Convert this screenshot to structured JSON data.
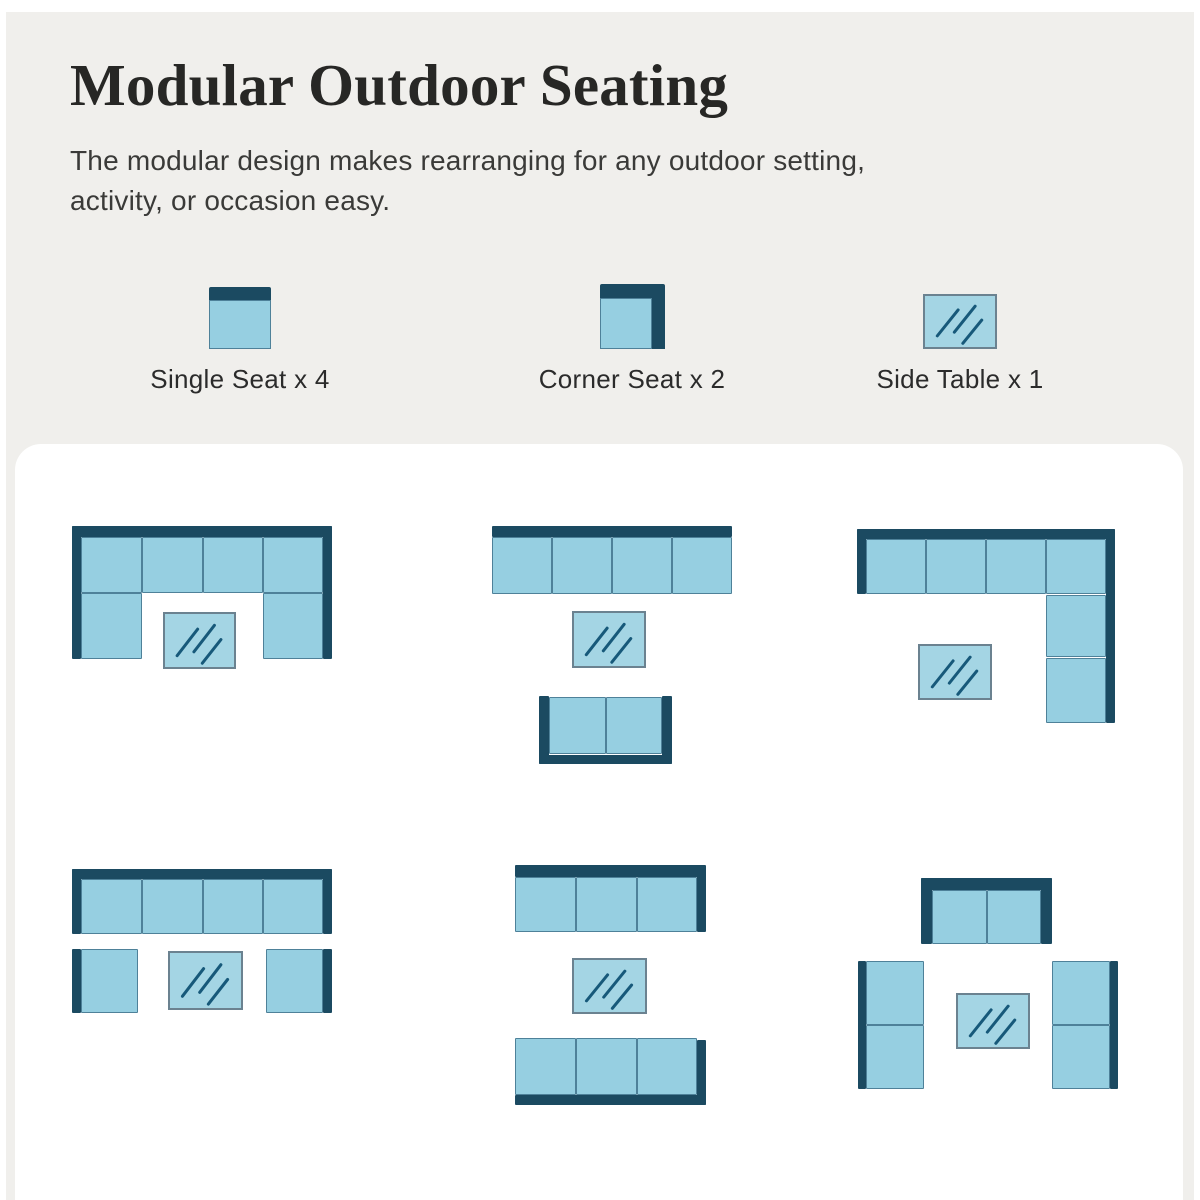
{
  "header": {
    "title": "Modular Outdoor Seating",
    "subtitle_line1": "The modular design makes rearranging for any outdoor setting,",
    "subtitle_line2": "activity, or occasion easy."
  },
  "colors": {
    "background": "#f0efec",
    "panel": "#ffffff",
    "navy": "#1b4a61",
    "cushion": "#96cfe1",
    "cushion_border": "#4e8199",
    "table_fill": "#a4d5e4",
    "table_border": "#6b8290",
    "table_line": "#17597a",
    "title_color": "#272725",
    "subtitle_color": "#3a3a38"
  },
  "legend": [
    {
      "id": "single-seat",
      "label": "Single Seat x 4"
    },
    {
      "id": "corner-seat",
      "label": "Corner Seat x 2"
    },
    {
      "id": "side-table",
      "label": "Side Table x 1"
    }
  ],
  "arrangements": [
    {
      "id": "u-shape-with-table",
      "x": 72,
      "y": 526,
      "w": 260,
      "h": 143,
      "pieces": [
        {
          "t": "bar",
          "x": 0,
          "y": 0,
          "w": 260,
          "h": 11
        },
        {
          "t": "bar",
          "x": 0,
          "y": 0,
          "w": 9,
          "h": 133
        },
        {
          "t": "bar",
          "x": 251,
          "y": 0,
          "w": 9,
          "h": 133
        },
        {
          "t": "cushion",
          "x": 9,
          "y": 11,
          "w": 61,
          "h": 56
        },
        {
          "t": "cushion",
          "x": 70,
          "y": 11,
          "w": 61,
          "h": 56
        },
        {
          "t": "cushion",
          "x": 131,
          "y": 11,
          "w": 60,
          "h": 56
        },
        {
          "t": "cushion",
          "x": 191,
          "y": 11,
          "w": 60,
          "h": 56
        },
        {
          "t": "cushion",
          "x": 9,
          "y": 67,
          "w": 61,
          "h": 66
        },
        {
          "t": "cushion",
          "x": 191,
          "y": 67,
          "w": 60,
          "h": 66
        },
        {
          "t": "table",
          "x": 91,
          "y": 86,
          "w": 73,
          "h": 57
        }
      ]
    },
    {
      "id": "sofa-table-loveseat",
      "x": 492,
      "y": 526,
      "w": 240,
      "h": 238,
      "pieces": [
        {
          "t": "bar",
          "x": 0,
          "y": 0,
          "w": 240,
          "h": 11
        },
        {
          "t": "cushion",
          "x": 0,
          "y": 11,
          "w": 60,
          "h": 57
        },
        {
          "t": "cushion",
          "x": 60,
          "y": 11,
          "w": 60,
          "h": 57
        },
        {
          "t": "cushion",
          "x": 120,
          "y": 11,
          "w": 60,
          "h": 57
        },
        {
          "t": "cushion",
          "x": 180,
          "y": 11,
          "w": 60,
          "h": 57
        },
        {
          "t": "table",
          "x": 80,
          "y": 85,
          "w": 74,
          "h": 57
        },
        {
          "t": "bar",
          "x": 47,
          "y": 170,
          "w": 10,
          "h": 68
        },
        {
          "t": "bar",
          "x": 170,
          "y": 170,
          "w": 10,
          "h": 68
        },
        {
          "t": "bar",
          "x": 47,
          "y": 229,
          "w": 133,
          "h": 9
        },
        {
          "t": "cushion",
          "x": 57,
          "y": 171,
          "w": 57,
          "h": 57
        },
        {
          "t": "cushion",
          "x": 114,
          "y": 171,
          "w": 56,
          "h": 57
        }
      ]
    },
    {
      "id": "l-shape-with-table",
      "x": 857,
      "y": 529,
      "w": 258,
      "h": 194,
      "pieces": [
        {
          "t": "bar",
          "x": 0,
          "y": 0,
          "w": 258,
          "h": 10
        },
        {
          "t": "bar",
          "x": 0,
          "y": 0,
          "w": 9,
          "h": 65
        },
        {
          "t": "bar",
          "x": 249,
          "y": 0,
          "w": 9,
          "h": 194
        },
        {
          "t": "cushion",
          "x": 9,
          "y": 10,
          "w": 60,
          "h": 55
        },
        {
          "t": "cushion",
          "x": 69,
          "y": 10,
          "w": 60,
          "h": 55
        },
        {
          "t": "cushion",
          "x": 129,
          "y": 10,
          "w": 60,
          "h": 55
        },
        {
          "t": "cushion",
          "x": 189,
          "y": 10,
          "w": 60,
          "h": 55
        },
        {
          "t": "cushion",
          "x": 189,
          "y": 66,
          "w": 60,
          "h": 62
        },
        {
          "t": "cushion",
          "x": 189,
          "y": 129,
          "w": 60,
          "h": 65
        },
        {
          "t": "table",
          "x": 61,
          "y": 115,
          "w": 74,
          "h": 56
        }
      ]
    },
    {
      "id": "sofa-with-two-chairs",
      "x": 72,
      "y": 869,
      "w": 260,
      "h": 145,
      "pieces": [
        {
          "t": "bar",
          "x": 0,
          "y": 0,
          "w": 260,
          "h": 10
        },
        {
          "t": "bar",
          "x": 0,
          "y": 0,
          "w": 9,
          "h": 65
        },
        {
          "t": "bar",
          "x": 251,
          "y": 0,
          "w": 9,
          "h": 65
        },
        {
          "t": "cushion",
          "x": 9,
          "y": 10,
          "w": 61,
          "h": 55
        },
        {
          "t": "cushion",
          "x": 70,
          "y": 10,
          "w": 61,
          "h": 55
        },
        {
          "t": "cushion",
          "x": 131,
          "y": 10,
          "w": 60,
          "h": 55
        },
        {
          "t": "cushion",
          "x": 191,
          "y": 10,
          "w": 60,
          "h": 55
        },
        {
          "t": "bar",
          "x": 0,
          "y": 80,
          "w": 9,
          "h": 64
        },
        {
          "t": "cushion",
          "x": 9,
          "y": 80,
          "w": 57,
          "h": 64
        },
        {
          "t": "table",
          "x": 96,
          "y": 82,
          "w": 75,
          "h": 59
        },
        {
          "t": "cushion",
          "x": 194,
          "y": 80,
          "w": 57,
          "h": 64
        },
        {
          "t": "bar",
          "x": 251,
          "y": 80,
          "w": 9,
          "h": 64
        }
      ]
    },
    {
      "id": "facing-rows-with-table",
      "x": 515,
      "y": 865,
      "w": 191,
      "h": 240,
      "pieces": [
        {
          "t": "bar",
          "x": 0,
          "y": 0,
          "w": 191,
          "h": 12
        },
        {
          "t": "bar",
          "x": 182,
          "y": 10,
          "w": 9,
          "h": 57
        },
        {
          "t": "cushion",
          "x": 0,
          "y": 12,
          "w": 61,
          "h": 55
        },
        {
          "t": "cushion",
          "x": 61,
          "y": 12,
          "w": 61,
          "h": 55
        },
        {
          "t": "cushion",
          "x": 122,
          "y": 12,
          "w": 60,
          "h": 55
        },
        {
          "t": "table",
          "x": 57,
          "y": 93,
          "w": 75,
          "h": 56
        },
        {
          "t": "cushion",
          "x": 0,
          "y": 173,
          "w": 61,
          "h": 57
        },
        {
          "t": "cushion",
          "x": 61,
          "y": 173,
          "w": 61,
          "h": 57
        },
        {
          "t": "cushion",
          "x": 122,
          "y": 173,
          "w": 60,
          "h": 57
        },
        {
          "t": "bar",
          "x": 0,
          "y": 230,
          "w": 191,
          "h": 10
        },
        {
          "t": "bar",
          "x": 182,
          "y": 175,
          "w": 9,
          "h": 65
        }
      ]
    },
    {
      "id": "square-conversation-set",
      "x": 858,
      "y": 878,
      "w": 260,
      "h": 212,
      "pieces": [
        {
          "t": "bar",
          "x": 63,
          "y": 0,
          "w": 131,
          "h": 12
        },
        {
          "t": "bar",
          "x": 63,
          "y": 0,
          "w": 11,
          "h": 66
        },
        {
          "t": "bar",
          "x": 183,
          "y": 0,
          "w": 11,
          "h": 66
        },
        {
          "t": "cushion",
          "x": 74,
          "y": 12,
          "w": 55,
          "h": 54
        },
        {
          "t": "cushion",
          "x": 129,
          "y": 12,
          "w": 54,
          "h": 54
        },
        {
          "t": "bar",
          "x": 0,
          "y": 83,
          "w": 8,
          "h": 128
        },
        {
          "t": "cushion",
          "x": 8,
          "y": 83,
          "w": 58,
          "h": 64
        },
        {
          "t": "cushion",
          "x": 8,
          "y": 147,
          "w": 58,
          "h": 64
        },
        {
          "t": "cushion",
          "x": 194,
          "y": 83,
          "w": 58,
          "h": 64
        },
        {
          "t": "cushion",
          "x": 194,
          "y": 147,
          "w": 58,
          "h": 64
        },
        {
          "t": "bar",
          "x": 252,
          "y": 83,
          "w": 8,
          "h": 128
        },
        {
          "t": "table",
          "x": 98,
          "y": 115,
          "w": 74,
          "h": 56
        }
      ]
    }
  ]
}
